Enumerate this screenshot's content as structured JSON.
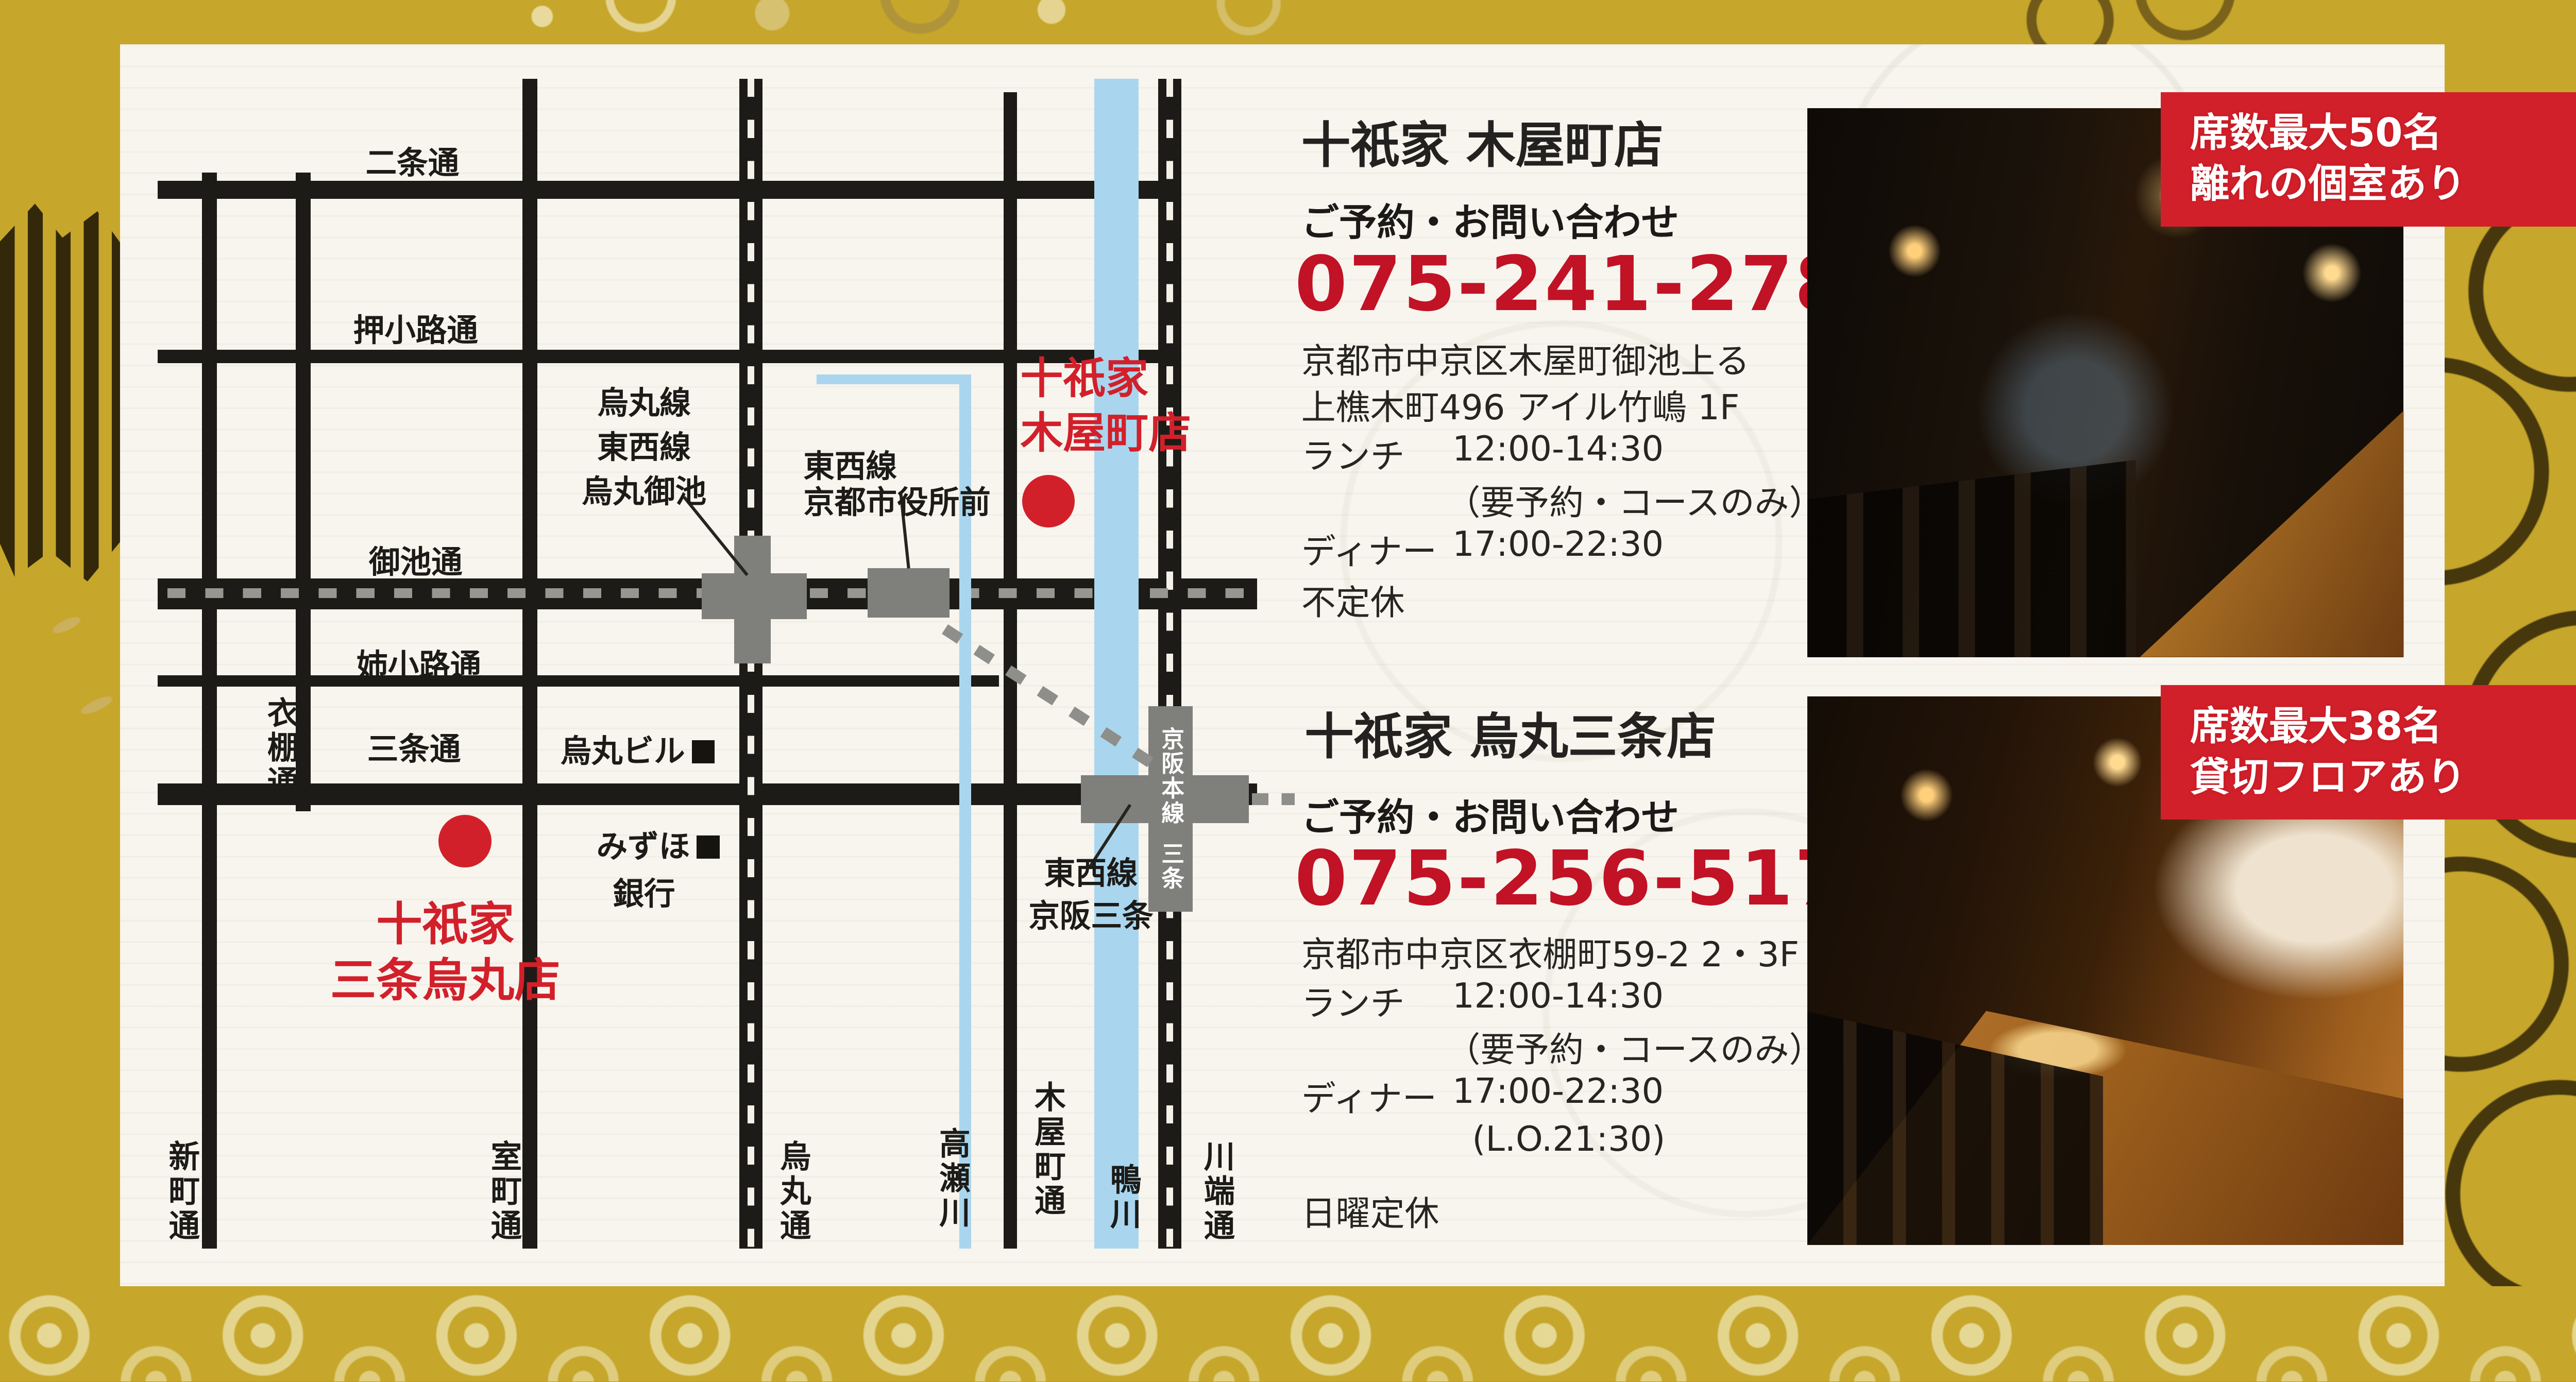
{
  "map": {
    "streets": {
      "nijo": "二条通",
      "oshikoji": "押小路通",
      "oike": "御池通",
      "anekoji": "姉小路通",
      "sanjo": "三条通",
      "shinmachi": "新町通",
      "koromodana": "衣棚通",
      "muromachi": "室町通",
      "karasuma": "烏丸通",
      "takasegawa": "高瀬川",
      "kiyamachi": "木屋町通",
      "kamogawa": "鴨川",
      "kawabata": "川端通"
    },
    "stations": {
      "karasuma_oike_l1": "烏丸線",
      "karasuma_oike_l2": "東西線",
      "karasuma_oike_l3": "烏丸御池",
      "shiyakusho_l1": "東西線",
      "shiyakusho_l2": "京都市役所前",
      "keihan_line": "京阪本線",
      "keihan_sanjo": "三条",
      "tozai_l1": "東西線",
      "tozai_l2": "京阪三条"
    },
    "landmarks": {
      "karasuma_bldg": "烏丸ビル",
      "mizuho_l1": "みずほ",
      "mizuho_l2": "銀行"
    },
    "markers": {
      "kiyamachi_l1": "十祇家",
      "kiyamachi_l2": "木屋町店",
      "sanjo_karasuma_l1": "十祇家",
      "sanjo_karasuma_l2": "三条烏丸店"
    }
  },
  "stores": [
    {
      "title": "十祇家 木屋町店",
      "contact_label": "ご予約・お問い合わせ",
      "phone": "075-241-2788",
      "address1": "京都市中京区木屋町御池上る",
      "address2": "上樵木町496 アイル竹嶋 1F",
      "lunch_label": "ランチ",
      "lunch_hours": "12:00-14:30",
      "lunch_note": "（要予約・コースのみ）",
      "dinner_label": "ディナー",
      "dinner_hours": "17:00-22:30",
      "closed": "不定休"
    },
    {
      "title": "十祇家 烏丸三条店",
      "contact_label": "ご予約・お問い合わせ",
      "phone": "075-256-5177",
      "address1": "京都市中京区衣棚町59-2 2・3F",
      "lunch_label": "ランチ",
      "lunch_hours": "12:00-14:30",
      "lunch_note": "（要予約・コースのみ）",
      "dinner_label": "ディナー",
      "dinner_hours": "17:00-22:30",
      "dinner_note": "(L.O.21:30)",
      "closed": "日曜定休"
    }
  ],
  "badges": [
    {
      "line1": "席数最大50名",
      "line2": "離れの個室あり"
    },
    {
      "line1": "席数最大38名",
      "line2": "貸切フロアあり"
    }
  ],
  "colors": {
    "background_gold": "#c6a62b",
    "card": "#f7f5ee",
    "road_black": "#1d1b17",
    "river_blue": "#a9d6ee",
    "station_gray": "#7f7f7c",
    "accent_red": "#d2202b",
    "phone_red": "#c11226"
  }
}
